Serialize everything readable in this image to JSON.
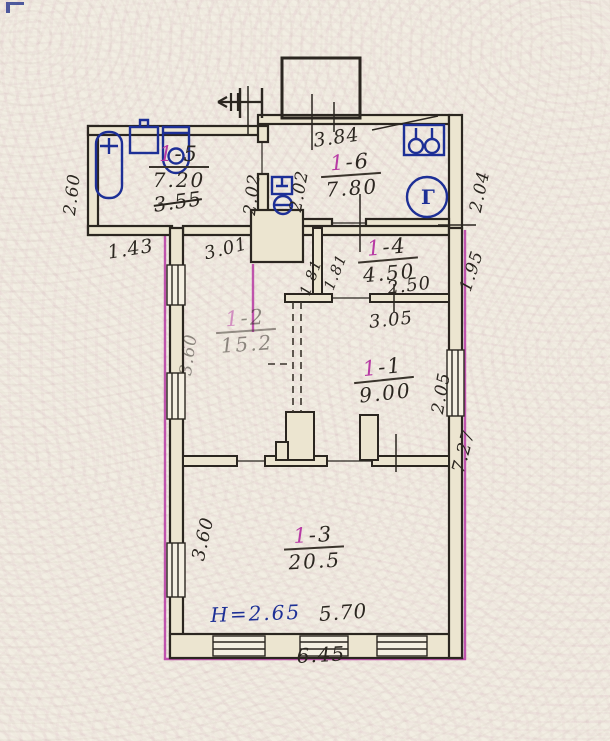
{
  "rooms": {
    "r15": {
      "number": "1-5",
      "area": "7.20",
      "crossed_note": "3.55"
    },
    "r16": {
      "number": "1-6",
      "area": "7.80"
    },
    "r14": {
      "number": "1-4",
      "area": "4.50"
    },
    "r12": {
      "number": "1-2",
      "area": "15.2"
    },
    "r11": {
      "number": "1-1",
      "area": "9.00"
    },
    "r13": {
      "number": "1-3",
      "area": "20.5"
    }
  },
  "dimensions": {
    "left_upper": "2.60",
    "left_offset": "1.43",
    "tambour_width": "2.02",
    "kitchen_left": "2.02",
    "kitchen_top": "3.84",
    "kitchen_right": "2.04",
    "hall_width": "3.01",
    "room14_wall_a": "1.81",
    "room14_wall_b": "1.81",
    "room14_right": "1.95",
    "room14_bottom": "2.50",
    "room11_top": "3.05",
    "room11_right": "2.05",
    "right_lower": "7.27",
    "room12_left": "3.60",
    "room13_left": "3.60",
    "room13_bottom": "5.70",
    "outer_bottom": "6.45"
  },
  "annotations": {
    "ceiling_height": "Н=2.65",
    "gas_meter_letter": "Г"
  },
  "colors": {
    "ink": "#2b2620",
    "blue": "#1d2f96",
    "magenta": "#b73aa4",
    "paper": "#f2eee3",
    "wall_fill": "#ece5d0"
  }
}
